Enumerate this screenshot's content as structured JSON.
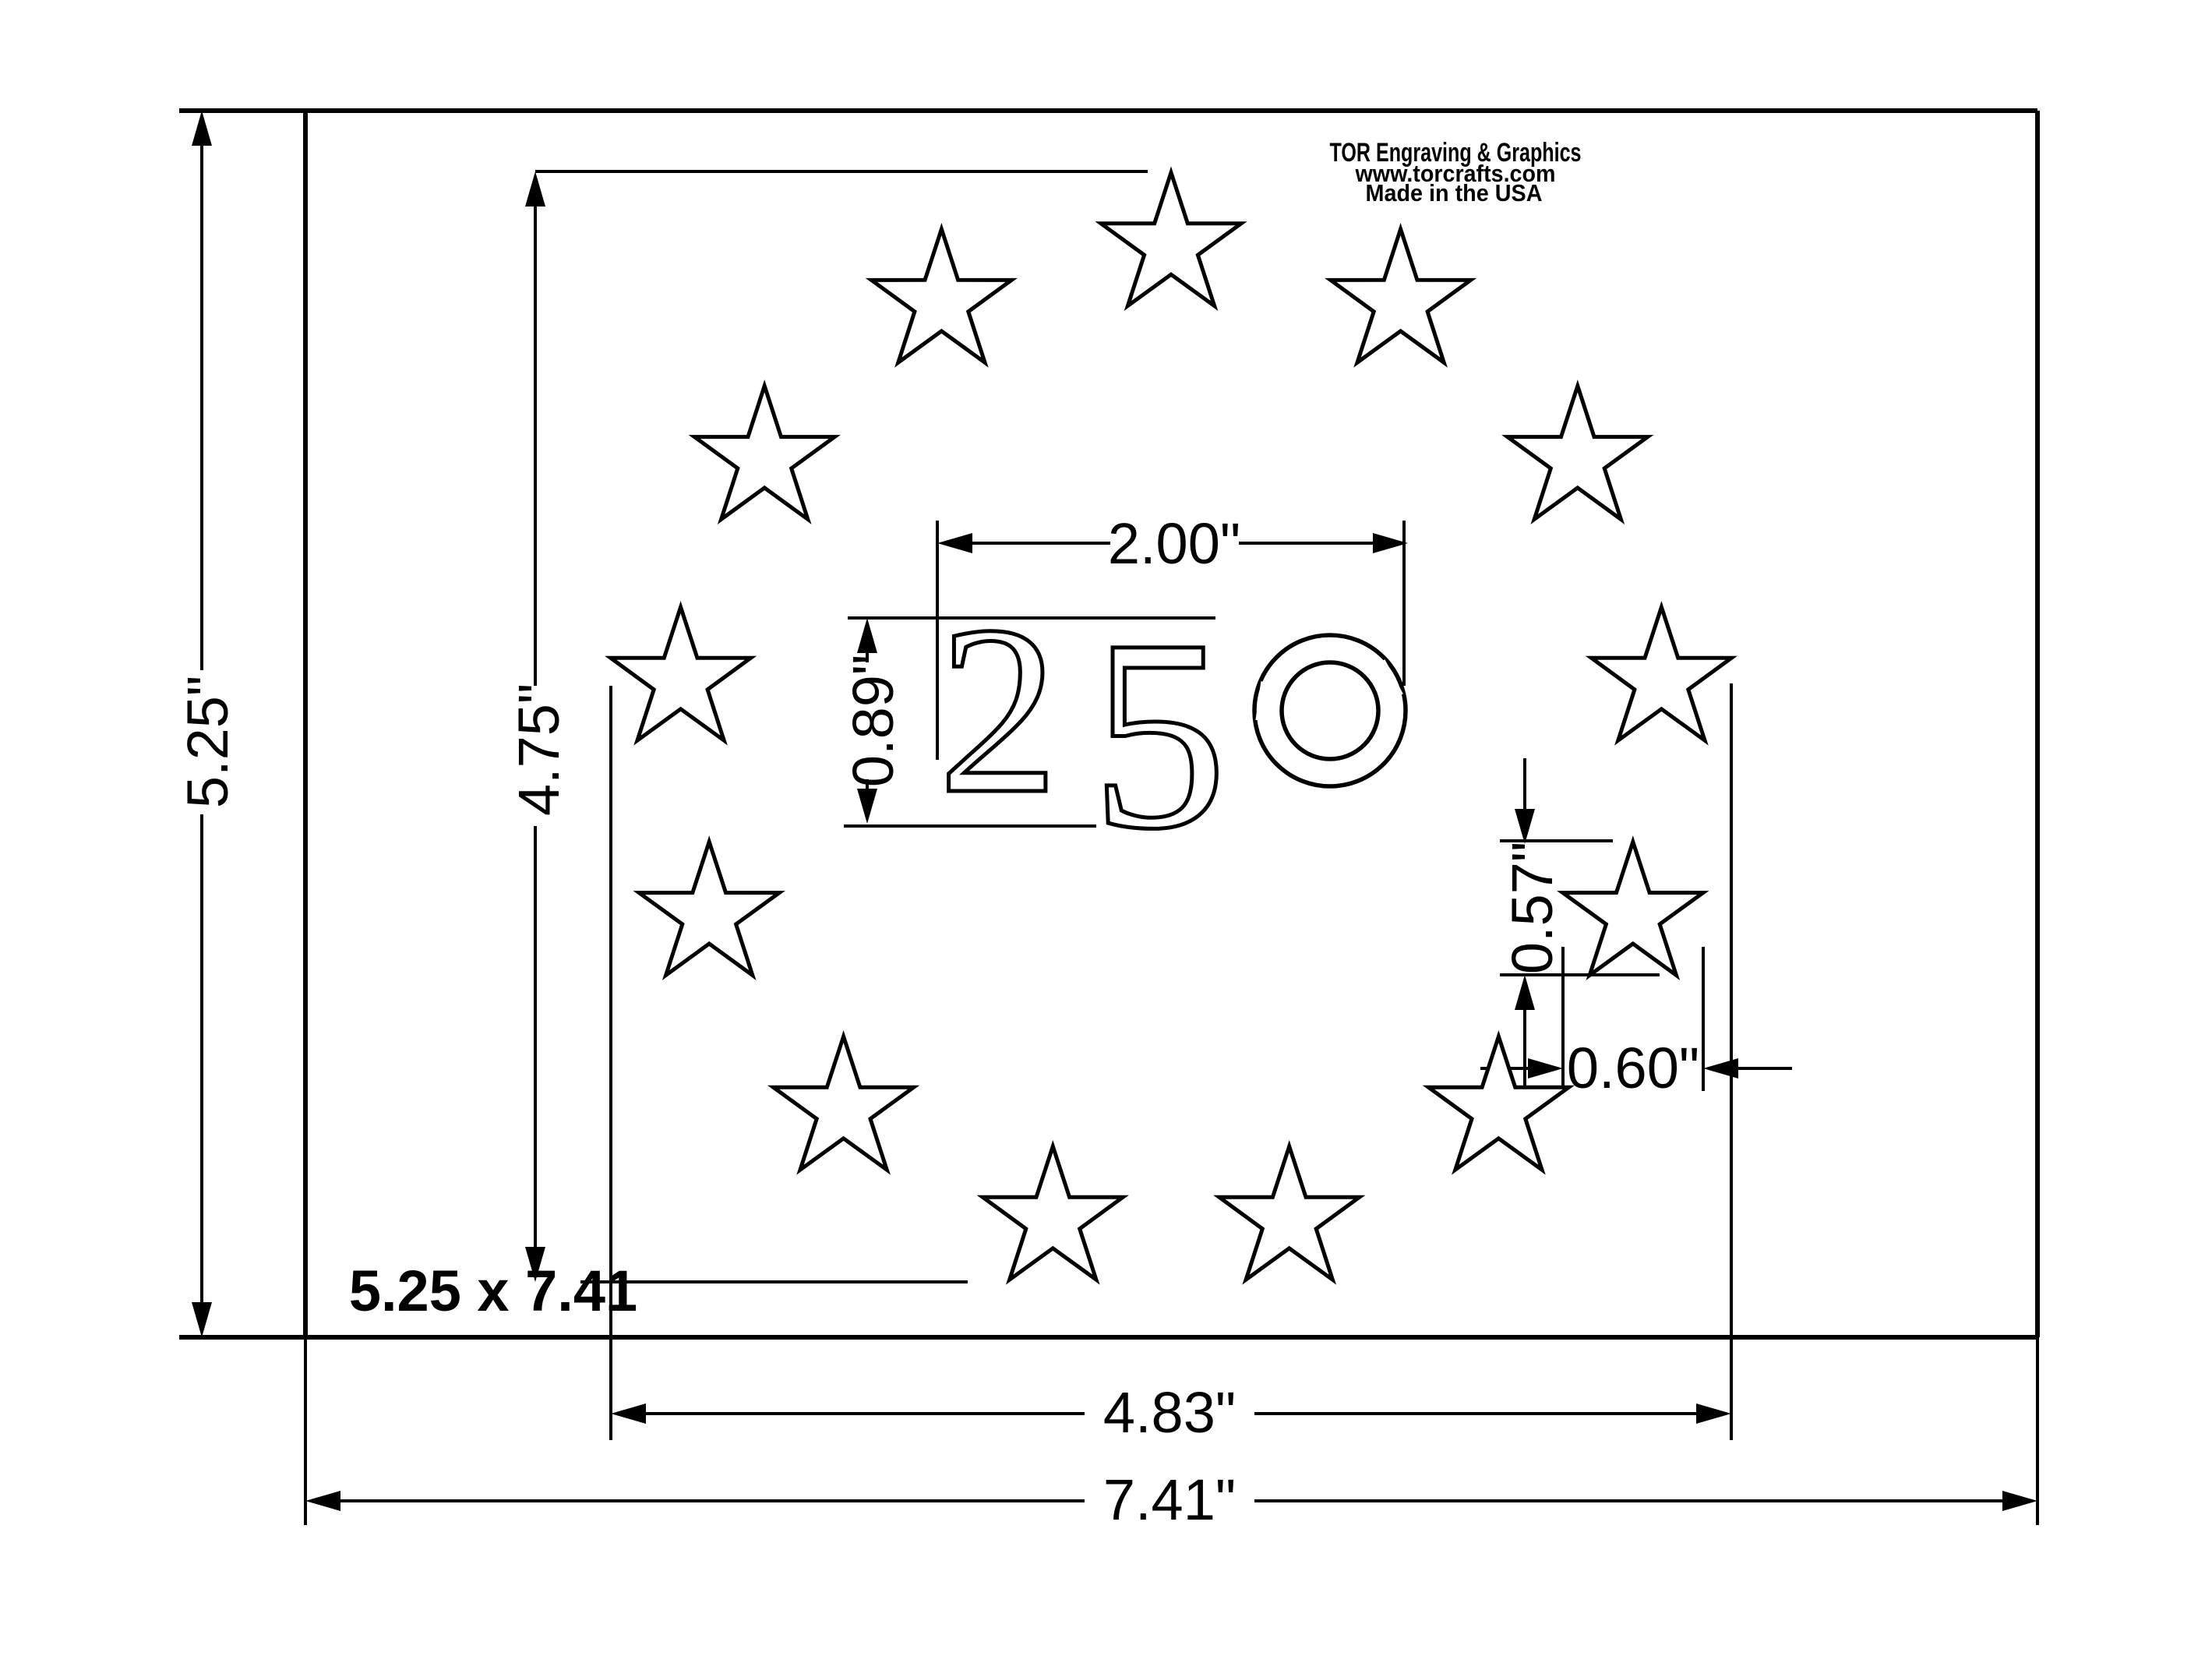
{
  "drawing": {
    "title_block": {
      "line1": "TOR Engraving & Graphics",
      "line2": "www.torcrafts.com",
      "line3": "Made in the USA"
    },
    "center_text": {
      "full": "250",
      "char1": "2",
      "char2": "5",
      "char3": "0"
    },
    "size_label": "5.25 x 7.41",
    "star_count": 13,
    "dimensions": {
      "overall_height": "5.25\"",
      "overall_width": "7.41\"",
      "star_ring_height": "4.75\"",
      "star_ring_width": "4.83\"",
      "number_width": "2.00\"",
      "number_height": "0.89\"",
      "star_height": "0.57\"",
      "star_width": "0.60\""
    },
    "colors": {
      "ink": "#000000",
      "paper": "#ffffff"
    }
  }
}
